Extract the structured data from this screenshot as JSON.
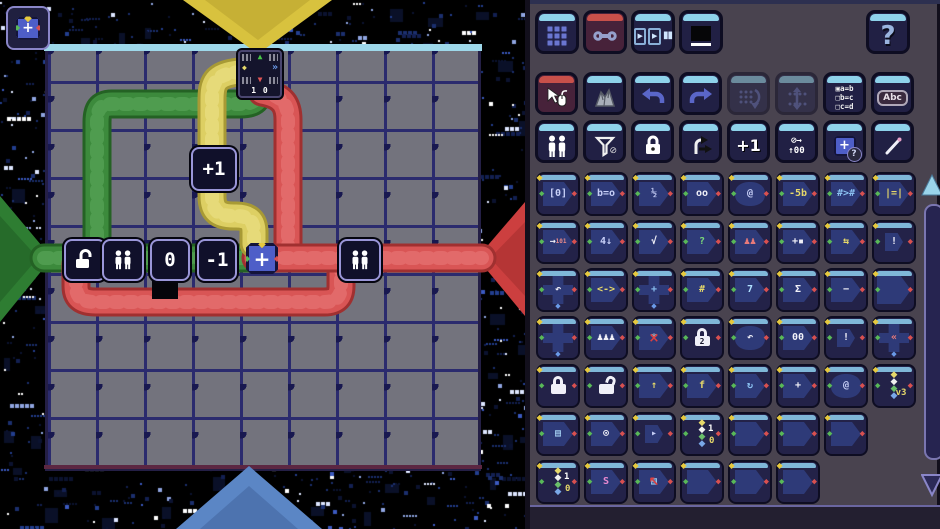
{
  "corner_button": {
    "glyph": "+"
  },
  "board": {
    "colors": {
      "yellow": "#ddcf63",
      "yellow_dark": "#a89a35",
      "green": "#3c8a3c",
      "green_dark": "#246224",
      "red": "#d95555",
      "red_dark": "#a03030",
      "port_top": "#d8c23e",
      "port_left": "#2e7d32",
      "port_right": "#cc3f3f",
      "port_bottom": "#5b86c5"
    },
    "exit_tile": {
      "n": "▲",
      "w": "◆",
      "e": "»",
      "s": "▼",
      "counter": "1 0"
    },
    "tiles": {
      "plus_one": "+1",
      "zero": "0",
      "minus_one": "-1",
      "plus": "+"
    }
  },
  "toolbar_top": {
    "buttons": [
      {
        "name": "levels"
      },
      {
        "name": "tools",
        "selected": true
      },
      {
        "name": "playback",
        "glyphs": [
          "▶",
          "▶",
          "▮▮"
        ]
      },
      {
        "name": "display"
      }
    ],
    "help": "?"
  },
  "toolbar_edit": [
    {
      "name": "select",
      "selected": true
    },
    {
      "name": "terrain"
    },
    {
      "name": "undo"
    },
    {
      "name": "redo"
    },
    {
      "name": "shift-columns",
      "disabled": true
    },
    {
      "name": "shift-rows",
      "disabled": true
    },
    {
      "name": "rules",
      "lines": [
        "▣a=b",
        "□b=c",
        "□c=d"
      ]
    },
    {
      "name": "text-label",
      "label": "Abc"
    }
  ],
  "toolbar_parts": [
    {
      "name": "people"
    },
    {
      "name": "filter-off",
      "badge": "⊘"
    },
    {
      "name": "lock"
    },
    {
      "name": "turns"
    },
    {
      "name": "increment",
      "label": "+1"
    },
    {
      "name": "cycle",
      "lines": [
        "⊘→",
        "↑00"
      ]
    },
    {
      "name": "chip-unknown",
      "label": "+",
      "badge": "?"
    },
    {
      "name": "pen"
    }
  ],
  "palette": {
    "connector": "◆",
    "snake_colors": [
      "#e6d86a",
      "#f0f0f0",
      "#6abf6a",
      "#7aa8e8"
    ],
    "rows": [
      [
        {
          "g": "[0]"
        },
        {
          "g": "b=o"
        },
        {
          "g": "½"
        },
        {
          "g": "oo",
          "cls": "white"
        },
        {
          "g": "@",
          "v": "round"
        },
        {
          "g": "-5b",
          "cls": "yellow"
        },
        {
          "g": "#>#",
          "cls": "blue"
        },
        {
          "g": "|=|",
          "cls": "yellow"
        }
      ],
      [
        {
          "g": "→",
          "g2": "101",
          "cls": "white"
        },
        {
          "g": "4↓"
        },
        {
          "g": "√",
          "cls": "white"
        },
        {
          "g": "?",
          "cls": "green"
        },
        {
          "g": "♟♟",
          "cls": "red"
        },
        {
          "g": "+▪",
          "cls": "white"
        },
        {
          "g": "⇆",
          "cls": "yellow"
        },
        {
          "g": "!",
          "v": "small",
          "cls": "white"
        }
      ],
      [
        {
          "v": "cross",
          "g": "↶",
          "cls": "white"
        },
        {
          "g": "<->",
          "cls": "yellow"
        },
        {
          "v": "cross",
          "g": "+",
          "cls": "blue"
        },
        {
          "g": "#",
          "cls": "yellow"
        },
        {
          "g": "7",
          "cls": "multi"
        },
        {
          "g": "Σ",
          "cls": "white"
        },
        {
          "g": "−",
          "cls": "white"
        },
        {
          "v": "big",
          "g": ""
        }
      ],
      [
        {
          "v": "cross",
          "g": ""
        },
        {
          "g": "♟♟♟",
          "cls": "white"
        },
        {
          "g": "*",
          "o": "×",
          "cls": "dim"
        },
        {
          "v": "lock",
          "g": "2"
        },
        {
          "g": "↶",
          "v": "round",
          "cls": "white"
        },
        {
          "g": "00",
          "cls": "white"
        },
        {
          "g": "!",
          "v": "small",
          "cls": "white"
        },
        {
          "v": "cross",
          "g": "«",
          "cls": "red"
        }
      ],
      [
        {
          "v": "lock",
          "g": ""
        },
        {
          "v": "lock",
          "g": "",
          "cls": "open"
        },
        {
          "g": "↑",
          "cls": "yellow"
        },
        {
          "g": "f",
          "cls": "yellow"
        },
        {
          "g": "↻",
          "cls": "blue"
        },
        {
          "g": "+",
          "cls": "white"
        },
        {
          "g": "@",
          "v": "round"
        },
        {
          "v": "snake",
          "g2": "v3"
        }
      ],
      [
        {
          "g": "▤",
          "cls": "multi"
        },
        {
          "g": "⊙",
          "cls": "white"
        },
        {
          "g": "▸",
          "v": "small"
        },
        {
          "v": "snake",
          "g": "1",
          "g2": "0"
        },
        {
          "g": ""
        },
        {
          "g": ""
        },
        {
          "g": ""
        }
      ],
      [
        {
          "v": "snake",
          "g": "1",
          "g2": "0"
        },
        {
          "g": "S",
          "cls": "pink"
        },
        {
          "g": "▤",
          "o": "↖",
          "cls": "multi"
        },
        {
          "g": ""
        },
        {
          "g": ""
        },
        {
          "g": ""
        }
      ]
    ]
  }
}
